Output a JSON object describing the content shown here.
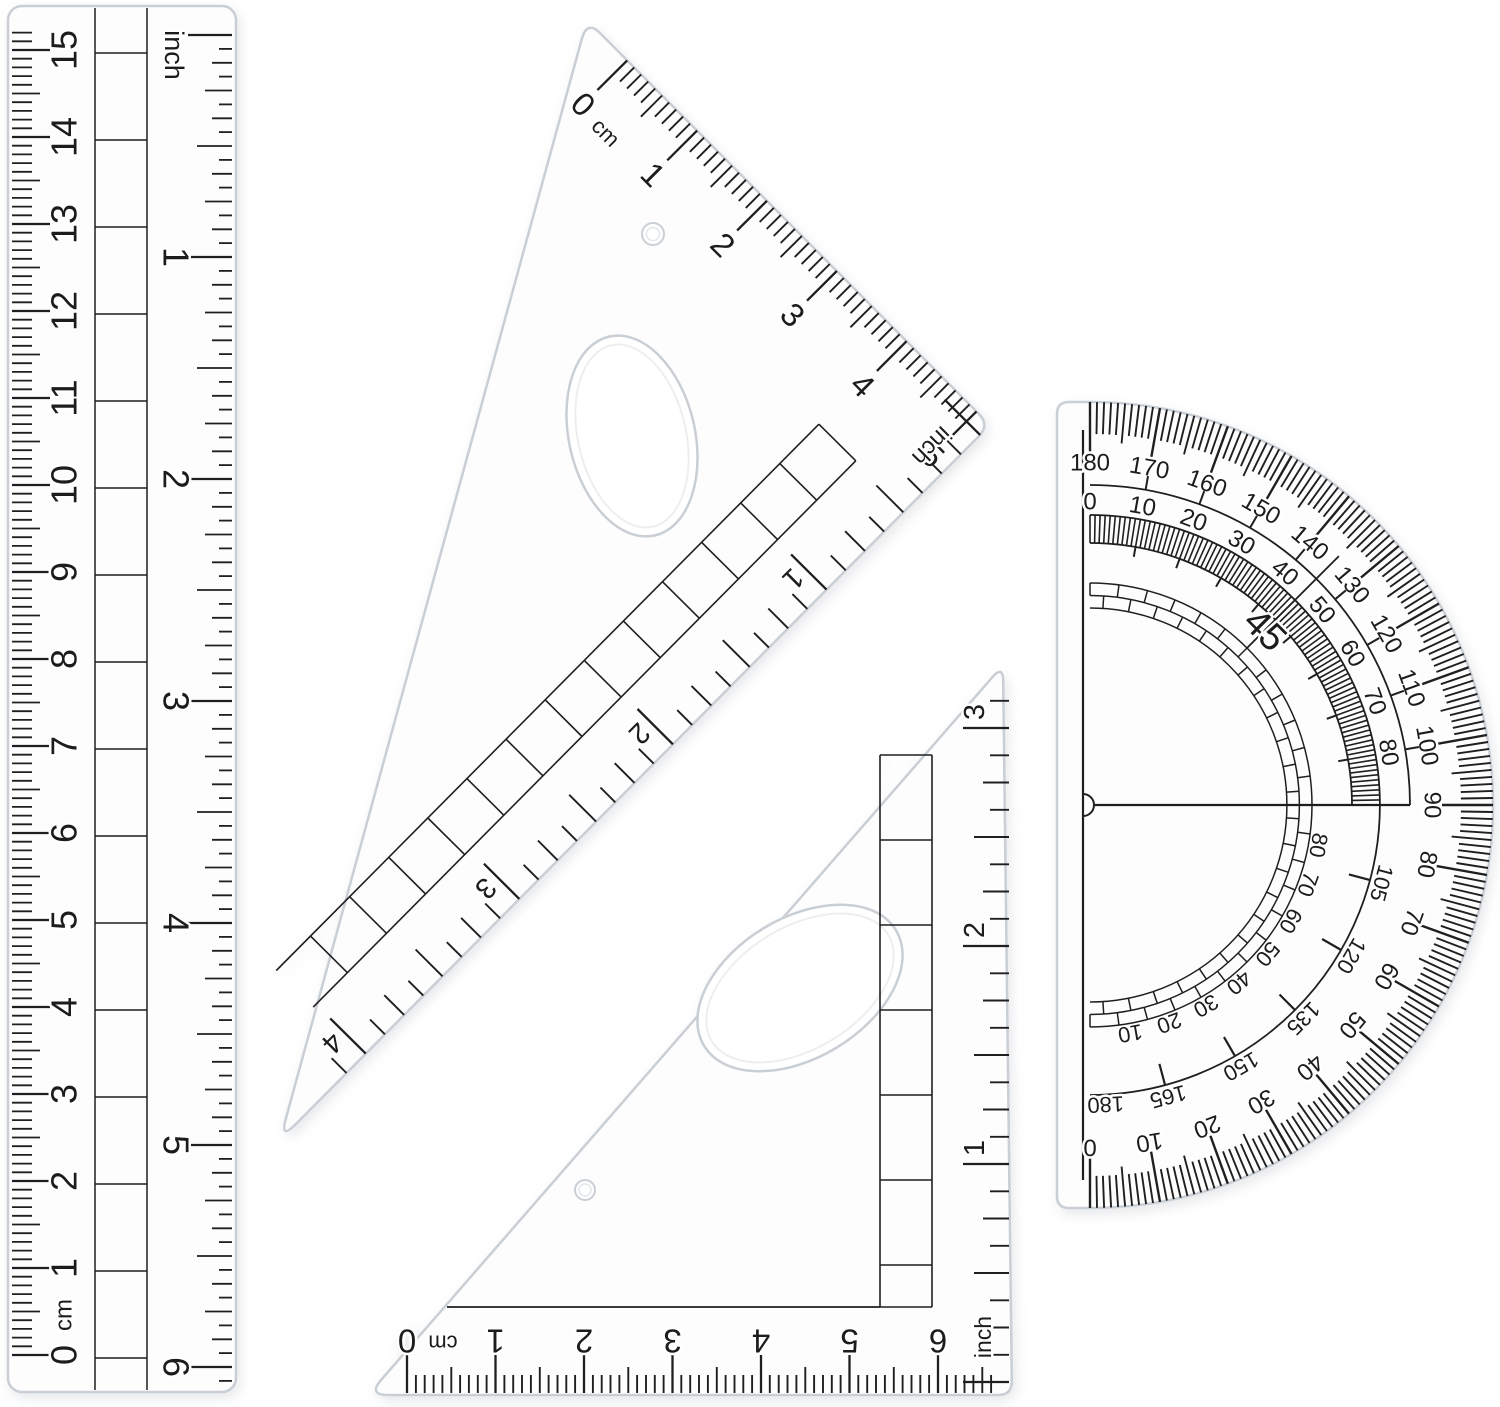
{
  "ruler": {
    "unit_cm": "cm",
    "cm_numbers": [
      "0",
      "1",
      "2",
      "3",
      "4",
      "5",
      "6",
      "7",
      "8",
      "9",
      "10",
      "11",
      "12",
      "13",
      "14",
      "15"
    ],
    "inch_title": "inch",
    "inch_numbers": [
      "1",
      "2",
      "3",
      "4",
      "5",
      "6"
    ]
  },
  "large_triangle": {
    "unit_cm": "cm",
    "cm_zero": "0",
    "cm_numbers": [
      "1",
      "2",
      "3",
      "4",
      "5"
    ],
    "inch_title": "inch",
    "inch_numbers": [
      "1",
      "2",
      "3",
      "4"
    ]
  },
  "small_triangle": {
    "unit_cm": "cm",
    "cm_zero": "0",
    "cm_numbers": [
      "1",
      "2",
      "3",
      "4",
      "5",
      "6"
    ],
    "inch_title": "inch",
    "inch_numbers": [
      "1",
      "2",
      "3"
    ]
  },
  "protractor": {
    "outer_scale": [
      "180",
      "170",
      "160",
      "150",
      "140",
      "130",
      "120",
      "110",
      "100",
      "90",
      "80",
      "70",
      "60",
      "50",
      "40",
      "30",
      "20",
      "10",
      "0"
    ],
    "inner_scale": [
      "0",
      "10",
      "20",
      "30",
      "40",
      "50",
      "60",
      "70",
      "80"
    ],
    "lower_scale_15": [
      "105",
      "120",
      "135",
      "150",
      "165"
    ],
    "lower_scale_end": "180",
    "lower_scale_reverse": [
      "80",
      "70",
      "60",
      "50",
      "40",
      "30",
      "20",
      "10"
    ],
    "diagonal_label": "45"
  },
  "colors": {
    "ink": "#1f1f1f",
    "edge": "#c9cfd4",
    "edge_soft": "#e7ebee",
    "plastic": "#fdfdfe",
    "background": "#ffffff"
  }
}
